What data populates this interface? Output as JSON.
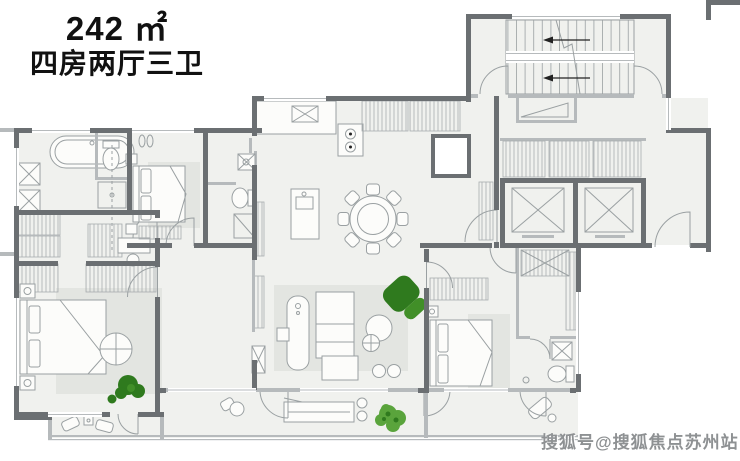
{
  "title": {
    "area": "242 ㎡",
    "rooms": "四房两厅三卫"
  },
  "watermark": {
    "text": "搜狐号@搜狐焦点苏州站"
  },
  "colors": {
    "background": "#ffffff",
    "wall_dark": "#6b6f72",
    "wall_light": "#b6babc",
    "floor": "#f0f1ee",
    "rug": "#e3e5e1",
    "furniture_stroke": "#9aa0a2",
    "furniture_fill": "#fcfcfa",
    "hatch_line": "#a8adaf",
    "plant_dark": "#2f7a1e",
    "plant_mid": "#418f28",
    "plant_light": "#5aa43c",
    "title_color": "#111111",
    "watermark_color": "#8e9193"
  }
}
